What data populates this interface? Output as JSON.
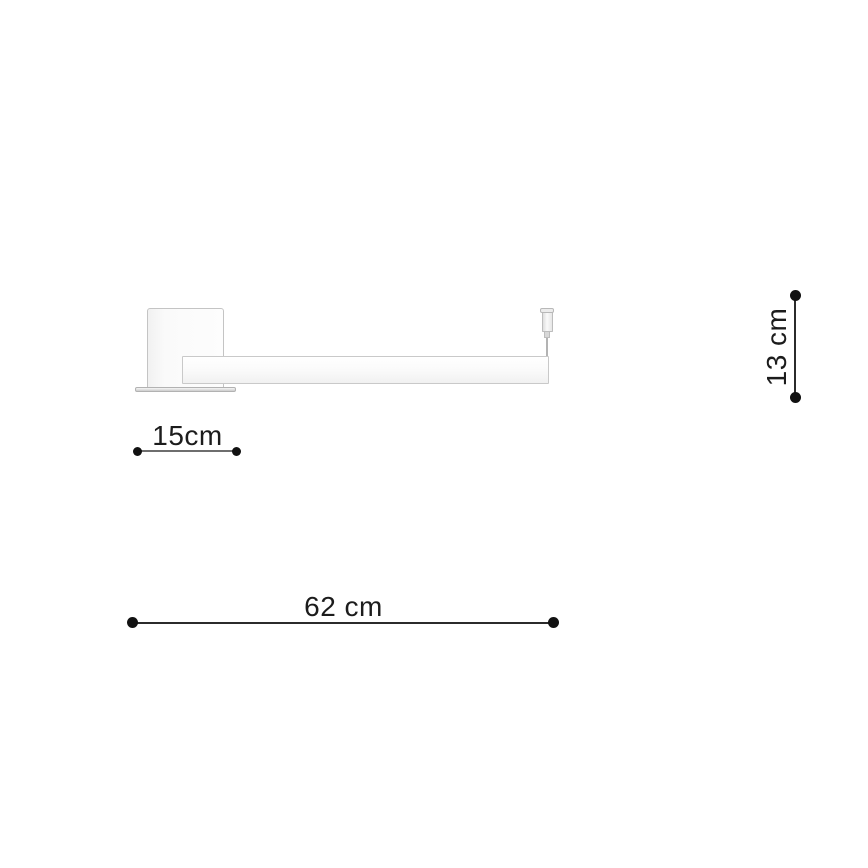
{
  "diagram": {
    "description": "Technical line drawing of a wall-mounted linear lamp with dimension annotations",
    "dimensions": {
      "mount_width": {
        "label": "15cm"
      },
      "total_width": {
        "label": "62 cm"
      },
      "height": {
        "label": "13 cm"
      }
    },
    "colors": {
      "background": "#ffffff",
      "fixture_outline": "#c4c4c4",
      "fixture_fill": "#fbfbfb",
      "mount_width_line": "#6e6e6e",
      "dimension_line": "#2b2b2b",
      "dimension_dot": "#111111",
      "label_text": "#1c1c1c"
    }
  }
}
